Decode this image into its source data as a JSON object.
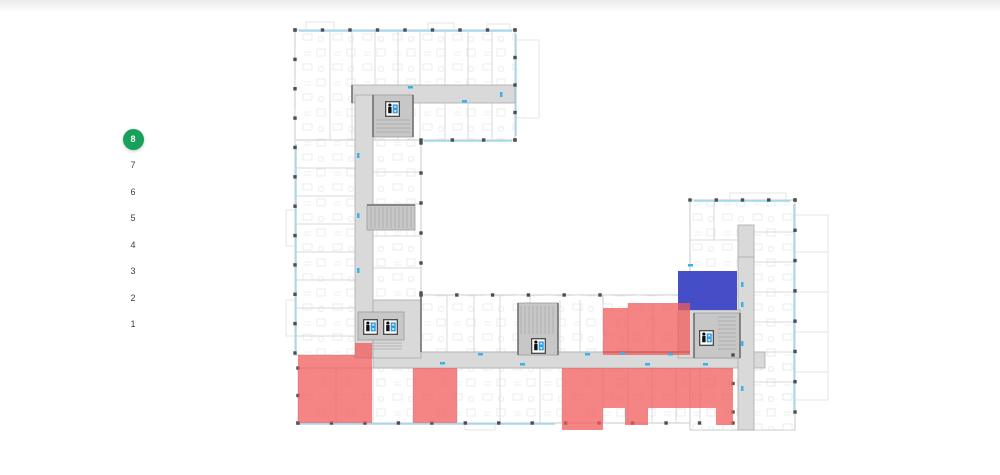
{
  "page": {
    "background": "#ffffff",
    "top_fade_color": "#ebebeb"
  },
  "floor_selector": {
    "active_color": "#17a05a",
    "active_text_color": "#ffffff",
    "text_color": "#3c4045",
    "floors": [
      {
        "label": "8",
        "active": true
      },
      {
        "label": "7",
        "active": false
      },
      {
        "label": "6",
        "active": false
      },
      {
        "label": "5",
        "active": false
      },
      {
        "label": "4",
        "active": false
      },
      {
        "label": "3",
        "active": false
      },
      {
        "label": "2",
        "active": false
      },
      {
        "label": "1",
        "active": false
      }
    ]
  },
  "plan": {
    "status_colors": {
      "selected": "#3f48c4",
      "unavailable": "#f15b5b"
    },
    "corridor_color": "#d9d9d9",
    "core_color": "#c7c7c7",
    "window_color": "#9ddcf3",
    "door_tick_color": "#39b4e6",
    "units": [
      {
        "id": "unit-selected-blue",
        "status": "selected",
        "color": "#3f48c4",
        "opacity": 0.97,
        "rects": [
          [
            678,
            271,
            59,
            39
          ]
        ]
      },
      {
        "id": "unit-unavailable-a",
        "status": "unavailable",
        "color": "#f15b5b",
        "opacity": 0.74,
        "rects": [
          [
            298,
            355,
            74,
            68
          ],
          [
            355,
            343,
            17,
            12
          ]
        ]
      },
      {
        "id": "unit-unavailable-b",
        "status": "unavailable",
        "color": "#f15b5b",
        "opacity": 0.74,
        "rects": [
          [
            413,
            368,
            44,
            55
          ]
        ]
      },
      {
        "id": "unit-unavailable-c",
        "status": "unavailable",
        "color": "#f15b5b",
        "opacity": 0.74,
        "rects": [
          [
            603,
            308,
            25,
            47
          ],
          [
            628,
            303,
            62,
            52
          ]
        ]
      },
      {
        "id": "unit-unavailable-d",
        "status": "unavailable",
        "color": "#f15b5b",
        "opacity": 0.74,
        "rects": [
          [
            562,
            368,
            41,
            62
          ],
          [
            603,
            368,
            130,
            40
          ],
          [
            625,
            408,
            23,
            17
          ],
          [
            716,
            408,
            17,
            17
          ]
        ]
      }
    ],
    "elevators": [
      [
        385,
        101
      ],
      [
        363,
        319
      ],
      [
        383,
        319
      ],
      [
        531,
        338
      ],
      [
        699,
        330
      ]
    ]
  }
}
